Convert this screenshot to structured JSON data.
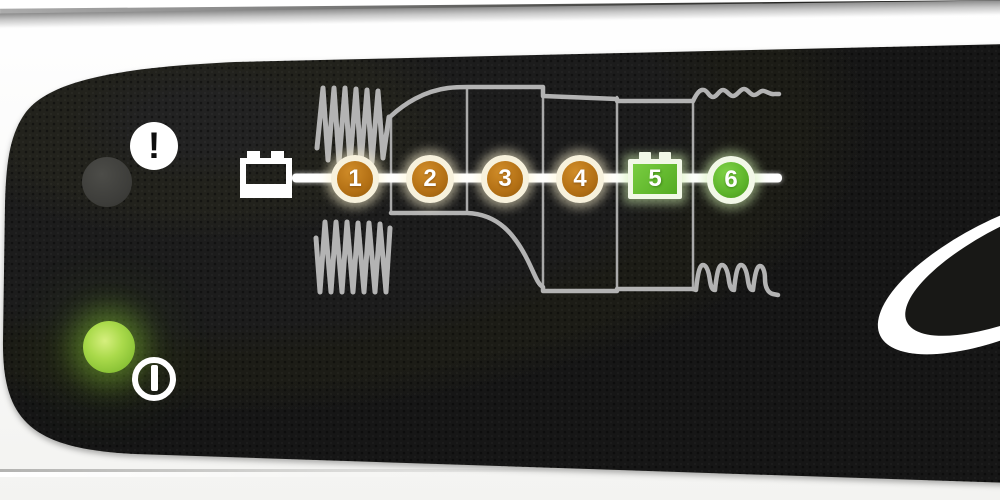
{
  "device": {
    "panel_color": "#1a1a18",
    "housing_color": "#f6f6f4",
    "waveform_color": "#b3b3b3",
    "timeline_color": "#ffffff"
  },
  "indicators": {
    "warning": {
      "symbol": "!",
      "led_state": "off",
      "led_color": "#3d3d3a"
    },
    "power": {
      "symbol": "power",
      "led_state": "on",
      "led_color": "#9ed143"
    }
  },
  "stages": [
    {
      "label": "1",
      "shape": "circle",
      "color": "#b26f14",
      "state": "lit-orange"
    },
    {
      "label": "2",
      "shape": "circle",
      "color": "#b26f14",
      "state": "lit-orange"
    },
    {
      "label": "3",
      "shape": "circle",
      "color": "#b26f14",
      "state": "lit-orange"
    },
    {
      "label": "4",
      "shape": "circle",
      "color": "#b26f14",
      "state": "lit-orange"
    },
    {
      "label": "5",
      "shape": "battery",
      "color": "#5cb32a",
      "state": "lit-green"
    },
    {
      "label": "6",
      "shape": "circle",
      "color": "#5cb32a",
      "state": "lit-green"
    }
  ],
  "diagram": {
    "start_icon": "battery",
    "top_curve_segments": [
      "dense-zigzag",
      "rising-curve",
      "flat-high",
      "step-down-slope",
      "flat",
      "small-wave"
    ],
    "bottom_curve_segments": [
      "dense-zigzag",
      "flat-high",
      "falling-curve",
      "flat-low",
      "flat-low",
      "pulse-spikes"
    ]
  },
  "logo": {
    "shape": "white-ellipse-swoosh"
  }
}
